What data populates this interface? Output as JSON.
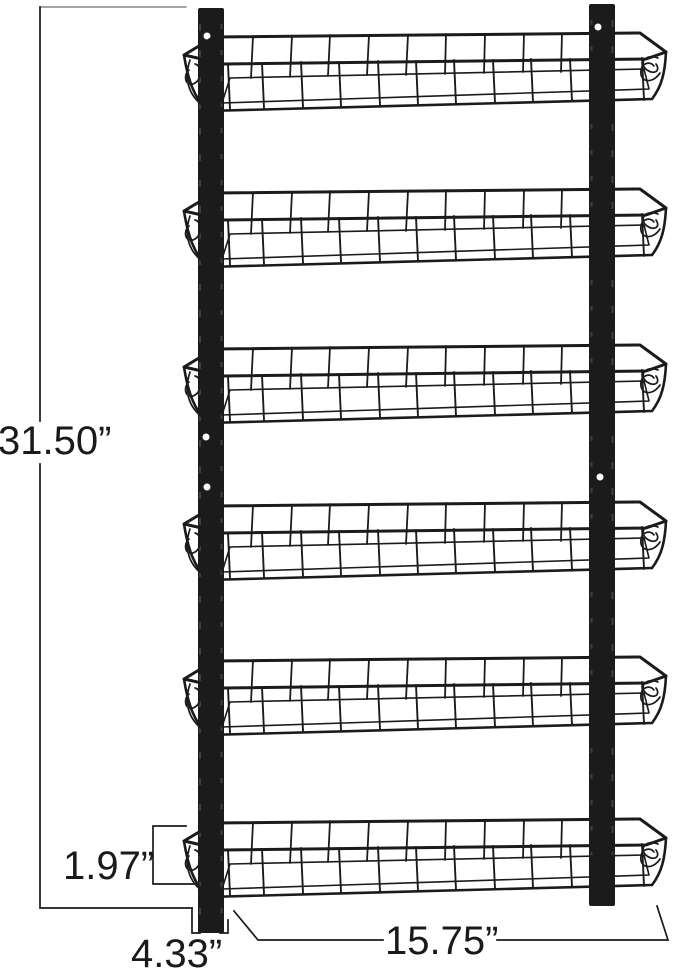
{
  "rack": {
    "tiers": 6
  },
  "dimensions": {
    "overall_height": "31.50”",
    "basket_front_height": "1.97”",
    "side_depth": "4.33”",
    "basket_width": "15.75”"
  },
  "colors": {
    "background": "#ffffff",
    "metal": "#1b1b1b",
    "dimension_line": "#1a1a1a",
    "mesh_fill": "#e8e8e8"
  }
}
